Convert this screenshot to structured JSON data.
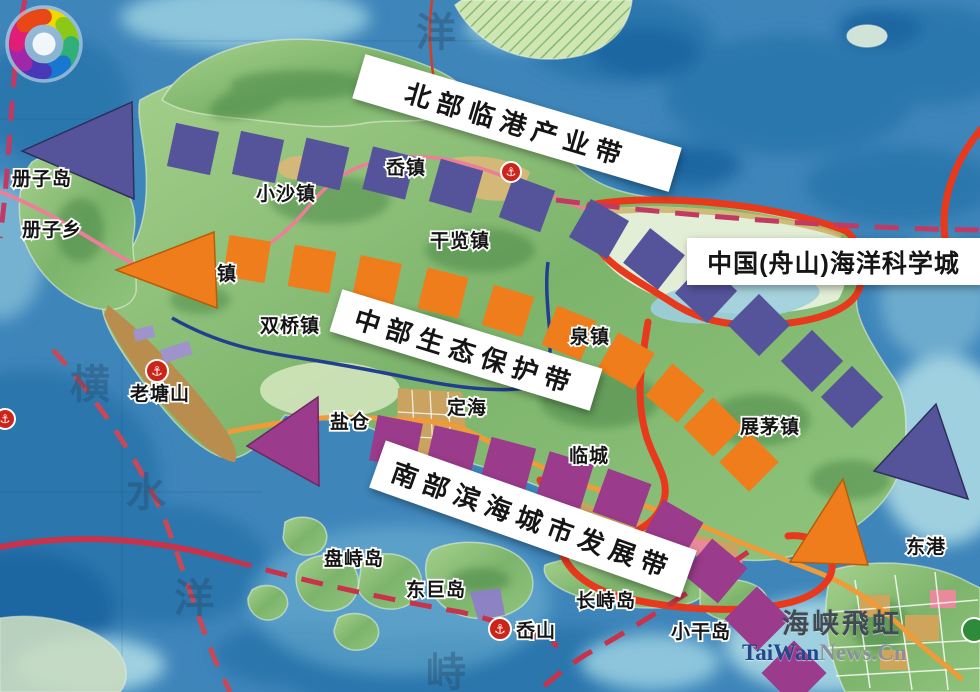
{
  "belts": {
    "north": {
      "label": "北部临港产业带",
      "color": "#55549b"
    },
    "central": {
      "label": "中部生态保护带",
      "color": "#ef7d1b"
    },
    "south": {
      "label": "南部滨海城市发展带",
      "color": "#9a3b8b"
    }
  },
  "science_city": {
    "label": "中国(舟山)海洋科学城",
    "boundary_color": "#e8391c"
  },
  "places": {
    "cezidao": "册子岛",
    "cezixiang": "册子乡",
    "xiaosha": "小沙镇",
    "ao": "岙镇",
    "ganlan": "干览镇",
    "shuangqiao": "双桥镇",
    "laotangshan": "老塘山",
    "yancang": "盐仓",
    "dinghai": "定海",
    "quan": "泉镇",
    "lincheng": "临城",
    "zhanmao": "展茅镇",
    "donggang": "东港",
    "panzhi": "盘峙岛",
    "dongju": "东巨岛",
    "changzhi": "长峙岛",
    "aoshan": "岙山",
    "xiaogan": "小干岛",
    "zhen": "镇"
  },
  "sea_labels": {
    "top": "洋",
    "v1": "横",
    "v2": "水",
    "v3": "洋",
    "bottom": "峙"
  },
  "watermark": {
    "brand": "海峡飛虹",
    "site_a": "TaiWan",
    "site_b": "News.Cn"
  },
  "icons": {
    "anchor": "⚓"
  }
}
